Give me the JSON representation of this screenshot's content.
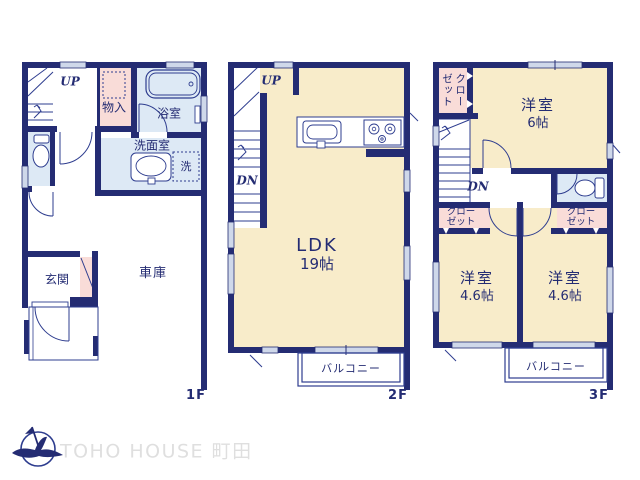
{
  "colors": {
    "wall_navy": "#242c73",
    "line_navy": "#2e3d8f",
    "room_cream": "#f8ecca",
    "wet_area_blue": "#dde9f5",
    "closet_pink": "#f9dcd8",
    "window_fill": "#cfd8ea",
    "brand_gray": "#dfdfdf"
  },
  "floor1": {
    "floor_label": "1F",
    "up": "UP",
    "storage": "物入",
    "bathroom": "浴室",
    "washroom": "洗面室",
    "washer": "洗",
    "entrance": "玄関",
    "garage": "車庫"
  },
  "floor2": {
    "floor_label": "2F",
    "up": "UP",
    "down": "DN",
    "ldk": "LDK",
    "ldk_size": "19帖",
    "balcony": "バルコニー"
  },
  "floor3": {
    "floor_label": "3F",
    "down": "DN",
    "closet_main": "クローゼット",
    "bedroom1": "洋室",
    "bedroom1_size": "6帖",
    "closet_left": "クローゼット",
    "closet_right": "クローゼット",
    "bedroom2": "洋室",
    "bedroom2_size": "4.6帖",
    "bedroom3": "洋室",
    "bedroom3_size": "4.6帖",
    "balcony": "バルコニー"
  },
  "footer": {
    "brand": "TOHO HOUSE 町田"
  }
}
